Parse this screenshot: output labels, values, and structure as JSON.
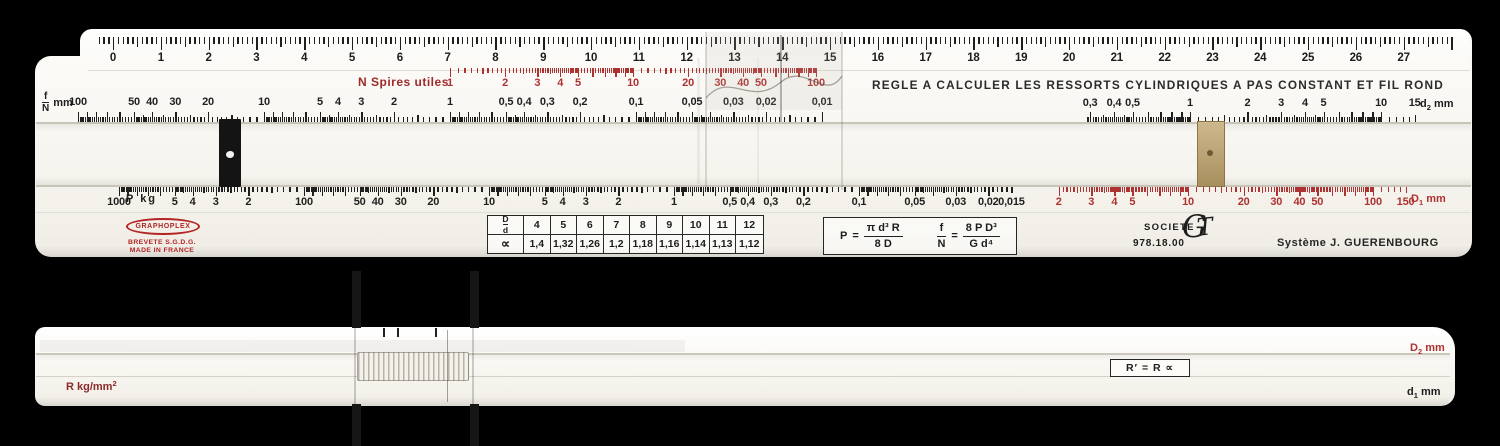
{
  "colors": {
    "scale_red": "#ae3232",
    "label_red": "#9e2a2a",
    "ink": "#1f1f1f",
    "logo_red": "#b32525",
    "brass": "#b59a67"
  },
  "front": {
    "cm": {
      "values": [
        "0",
        "1",
        "2",
        "3",
        "4",
        "5",
        "6",
        "7",
        "8",
        "9",
        "10",
        "11",
        "12",
        "13",
        "14",
        "15",
        "16",
        "17",
        "18",
        "19",
        "20",
        "21",
        "22",
        "23",
        "24",
        "25",
        "26",
        "27"
      ]
    },
    "n_spires": {
      "label": "N Spires utiles",
      "labels": [
        "1",
        "2",
        "3",
        "4",
        "5",
        "10",
        "20",
        "30",
        "40",
        "50",
        "100"
      ],
      "values": [
        1,
        2,
        3,
        4,
        5,
        10,
        20,
        30,
        40,
        50,
        100
      ]
    },
    "title": "REGLE A CALCULER LES RESSORTS CYLINDRIQUES A PAS CONSTANT ET FIL ROND",
    "fn": {
      "label_num": "f",
      "label_den": "N",
      "label_unit": "mm",
      "labels": [
        "100",
        "50",
        "40",
        "30",
        "20",
        "10",
        "5",
        "4",
        "3",
        "2",
        "1",
        "0,5",
        "0,4",
        "0,3",
        "0,2",
        "0,1",
        "0,05",
        "0,03",
        "0,02",
        "0,01"
      ],
      "values": [
        100,
        50,
        40,
        30,
        20,
        10,
        5,
        4,
        3,
        2,
        1,
        0.5,
        0.4,
        0.3,
        0.2,
        0.1,
        0.05,
        0.03,
        0.02,
        0.01
      ]
    },
    "d2": {
      "label_main": "d",
      "label_sub": "2",
      "label_unit": "mm",
      "labels": [
        "0,3",
        "0,4",
        "0,5",
        "1",
        "2",
        "3",
        "4",
        "5",
        "10",
        "15"
      ],
      "values": [
        0.3,
        0.4,
        0.5,
        1,
        2,
        3,
        4,
        5,
        10,
        15
      ]
    },
    "p": {
      "label": "P kg",
      "labels": [
        "1000",
        "5",
        "4",
        "3",
        "2",
        "100",
        "50",
        "40",
        "30",
        "20",
        "10",
        "5",
        "4",
        "3",
        "2",
        "1",
        "0,5",
        "0,4",
        "0,3",
        "0,2",
        "0,1",
        "0,05",
        "0,03",
        "0,02",
        "0,015"
      ],
      "values": [
        1000,
        500,
        400,
        300,
        200,
        100,
        50,
        40,
        30,
        20,
        10,
        5,
        4,
        3,
        2,
        1,
        0.5,
        0.4,
        0.3,
        0.2,
        0.1,
        0.05,
        0.03,
        0.02,
        0.015
      ]
    },
    "d1": {
      "label_main": "D",
      "label_sub": "1",
      "label_unit": "mm",
      "labels": [
        "2",
        "3",
        "4",
        "5",
        "10",
        "20",
        "30",
        "40",
        "50",
        "100",
        "150"
      ],
      "values": [
        2,
        3,
        4,
        5,
        10,
        20,
        30,
        40,
        50,
        100,
        150
      ]
    },
    "table": {
      "corner_num": "D",
      "corner_den": "d",
      "cols": [
        "4",
        "5",
        "6",
        "7",
        "8",
        "9",
        "10",
        "11",
        "12"
      ],
      "row_label": "∝",
      "row_values": [
        "1,4",
        "1,32",
        "1,26",
        "1,2",
        "1,18",
        "1,16",
        "1,14",
        "1,13",
        "1,12"
      ]
    },
    "formulas": {
      "f1_lhs": "P",
      "f1_num": "π d³ R",
      "f1_den": "8 D",
      "f2_lhs_num": "f",
      "f2_lhs_den": "N",
      "f2_num": "8 P D³",
      "f2_den": "G d⁴"
    },
    "branding": {
      "graphoplex": "GRAPHOPLEX",
      "brevete": "BREVETE S.G.D.G.",
      "made": "MADE IN FRANCE",
      "societe": "SOCIETE",
      "gt": "G",
      "gt2": "T",
      "ref": "978.18.00",
      "systeme": "Système J. GUERENBOURG"
    }
  },
  "back": {
    "d2": {
      "label_main": "D",
      "label_sub": "2",
      "label_unit": "mm",
      "labels": [
        "2",
        "3",
        "4",
        "5",
        "6",
        "7",
        "8",
        "9",
        "10",
        "15",
        "20",
        "30",
        "40",
        "50",
        "60",
        "70",
        "80",
        "90",
        "100",
        "150"
      ],
      "values": [
        2,
        3,
        4,
        5,
        6,
        7,
        8,
        9,
        10,
        15,
        20,
        30,
        40,
        50,
        60,
        70,
        80,
        90,
        100,
        150
      ]
    },
    "rbox": "R′ = R ∝",
    "r": {
      "label_main": "R kg/mm",
      "label_sup": "2",
      "labels": [
        "100",
        "50",
        "40",
        "30",
        "20",
        "10",
        "5"
      ],
      "values": [
        100,
        50,
        40,
        30,
        20,
        10,
        5
      ]
    },
    "d1": {
      "label_main": "d",
      "label_sub": "1",
      "label_unit": "mm",
      "labels": [
        "0,3",
        "0,4",
        "0,5",
        "0,6",
        "0,7",
        "0,8",
        "0,9",
        "1",
        "1,5",
        "2",
        "3",
        "4",
        "5",
        "6",
        "7",
        "8",
        "9",
        "10",
        "11",
        "12",
        "13",
        "14",
        "15"
      ],
      "values": [
        0.3,
        0.4,
        0.5,
        0.6,
        0.7,
        0.8,
        0.9,
        1,
        1.5,
        2,
        3,
        4,
        5,
        6,
        7,
        8,
        9,
        10,
        11,
        12,
        13,
        14,
        15
      ]
    }
  }
}
